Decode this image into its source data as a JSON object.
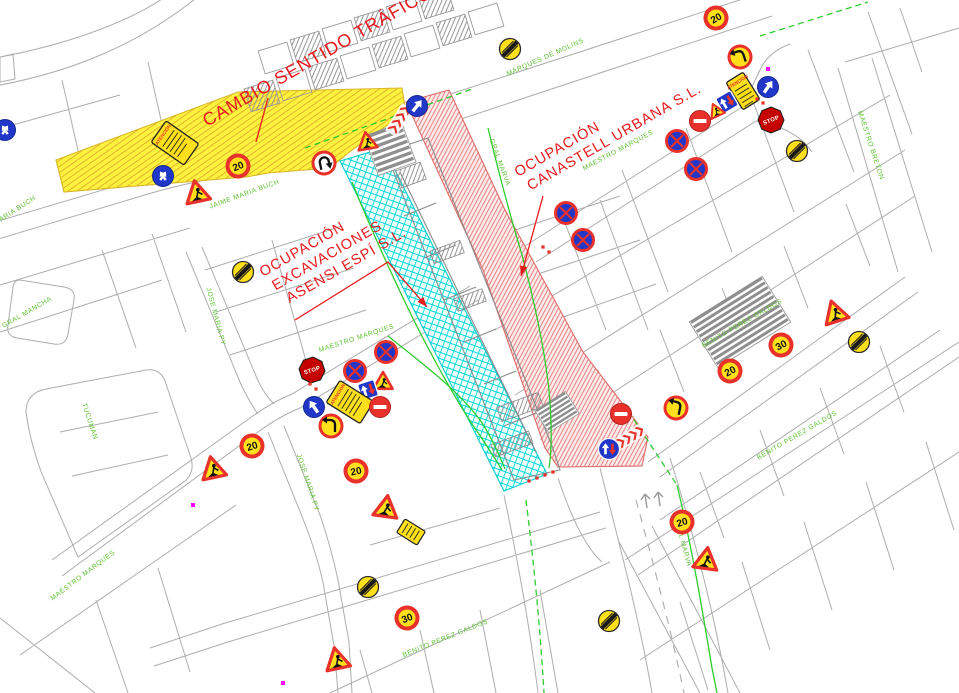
{
  "map": {
    "title": "Plano de ocupación y señalización de tráfico",
    "panel_label": "ATENCIÓN",
    "colors": {
      "parcel_line": "#adadad",
      "building_line": "#8a8a8a",
      "street_label_green": "#5cc22e",
      "annotation_red": "#e8191c",
      "green_line": "#2ecc2e",
      "zone_yellow": "#fff23f",
      "zone_cyan": "#00d8d8",
      "zone_red": "#e98080",
      "sign_red": "#e8312a",
      "sign_blue": "#2037c8",
      "sign_yellow": "#ffe01a",
      "magenta": "#ff00ff"
    },
    "annotations": [
      {
        "id": "cambio-sentido",
        "lines": [
          "CAMBIO SENTIDO TRÁFICO"
        ],
        "x": 207,
        "y": 127,
        "rot": -30,
        "size": 18,
        "leader": [
          [
            268,
            98
          ],
          [
            256,
            142
          ]
        ],
        "arrow": false
      },
      {
        "id": "ocupacion-canastell",
        "lines": [
          "OCUPACIÓN",
          "CANASTELL URBANA S.L."
        ],
        "x": 518,
        "y": 177,
        "rot": -30,
        "size": 14.5,
        "leader": [
          [
            543,
            196
          ],
          [
            521,
            276
          ]
        ],
        "arrow": true
      },
      {
        "id": "ocupacion-asensi",
        "lines": [
          "OCUPACIÓN",
          "EXCAVACIONES",
          "ASENSI ESPÍ S.L."
        ],
        "x": 263,
        "y": 277,
        "rot": -30,
        "size": 14.5,
        "leader": [
          [
            295,
            320
          ],
          [
            388,
            262
          ],
          [
            427,
            307
          ]
        ],
        "arrow": true
      }
    ],
    "street_labels": [
      {
        "text": "MARIA BUCH",
        "x": 16,
        "y": 212,
        "rot": -33
      },
      {
        "text": "JAIME MARIA BUCH",
        "x": 245,
        "y": 196,
        "rot": -20
      },
      {
        "text": "MARQUES DE MOLINS",
        "x": 546,
        "y": 59,
        "rot": -24
      },
      {
        "text": "GRAL MARVA",
        "x": 498,
        "y": 163,
        "rot": 70
      },
      {
        "text": "MAESTRO MARQUES",
        "x": 619,
        "y": 152,
        "rot": -28
      },
      {
        "text": "MAESTRO BRETON",
        "x": 869,
        "y": 146,
        "rot": 72
      },
      {
        "text": "GRAL MANCHA",
        "x": 28,
        "y": 314,
        "rot": -30
      },
      {
        "text": "JOSE MARIA PY",
        "x": 214,
        "y": 317,
        "rot": 75
      },
      {
        "text": "TUCUMAN",
        "x": 88,
        "y": 422,
        "rot": 72
      },
      {
        "text": "MAESTRO MARQUES",
        "x": 357,
        "y": 340,
        "rot": -18
      },
      {
        "text": "JOSE MARIA PY",
        "x": 306,
        "y": 483,
        "rot": 72
      },
      {
        "text": "MAESTRO MARQUES",
        "x": 84,
        "y": 577,
        "rot": -37
      },
      {
        "text": "BENITO PEREZ GALDOS",
        "x": 743,
        "y": 325,
        "rot": -30
      },
      {
        "text": "BENITO PEREZ GALDOS",
        "x": 798,
        "y": 437,
        "rot": -30
      },
      {
        "text": "BENITO PEREZ GALDOS",
        "x": 446,
        "y": 640,
        "rot": -22
      },
      {
        "text": "GRAL MARVA",
        "x": 681,
        "y": 543,
        "rot": 75
      }
    ],
    "zones": [
      {
        "id": "zone-cambio-sentido-trafico",
        "kind": "yellow",
        "points": [
          [
            56,
            160
          ],
          [
            238,
            92
          ],
          [
            402,
            88
          ],
          [
            406,
            112
          ],
          [
            352,
            150
          ],
          [
            330,
            168
          ],
          [
            268,
            173
          ],
          [
            246,
            177
          ],
          [
            64,
            192
          ]
        ]
      },
      {
        "id": "zone-ocupacion-asensi",
        "kind": "cyan",
        "points": [
          [
            340,
            161
          ],
          [
            384,
            148
          ],
          [
            547,
            474
          ],
          [
            504,
            491
          ]
        ]
      },
      {
        "id": "zone-ocupacion-canastell",
        "kind": "red",
        "points": [
          [
            406,
            102
          ],
          [
            449,
            90
          ],
          [
            505,
            210
          ],
          [
            583,
            352
          ],
          [
            648,
            437
          ],
          [
            642,
            466
          ],
          [
            558,
            467
          ],
          [
            545,
            448
          ],
          [
            483,
            270
          ]
        ]
      }
    ],
    "signs": [
      {
        "t": "panel",
        "x": 175,
        "y": 143,
        "r": -55,
        "w": 26,
        "h": 40
      },
      {
        "t": "blue-two",
        "x": 163,
        "y": 176,
        "r": 0
      },
      {
        "t": "works",
        "x": 197,
        "y": 193,
        "r": -12
      },
      {
        "t": "speed",
        "v": "20",
        "x": 238,
        "y": 166,
        "r": -22
      },
      {
        "t": "no-turn-w",
        "x": 324,
        "y": 163,
        "r": -12
      },
      {
        "t": "works",
        "x": 367,
        "y": 142,
        "r": -10,
        "s": 0.8
      },
      {
        "t": "chevrons",
        "x": 399,
        "y": 120,
        "r": -58
      },
      {
        "t": "blue-arrow",
        "x": 417,
        "y": 106,
        "r": 38
      },
      {
        "t": "end",
        "x": 243,
        "y": 272,
        "r": 0
      },
      {
        "t": "end",
        "x": 510,
        "y": 49,
        "r": 0
      },
      {
        "t": "speed",
        "v": "20",
        "x": 716,
        "y": 18,
        "r": -30
      },
      {
        "t": "no-turn-y",
        "x": 740,
        "y": 57,
        "r": -18
      },
      {
        "t": "panel",
        "x": 743,
        "y": 91,
        "r": -32,
        "w": 20,
        "h": 32
      },
      {
        "t": "blue-arrow",
        "x": 768,
        "y": 87,
        "r": 35
      },
      {
        "t": "priority",
        "x": 727,
        "y": 102,
        "r": -30
      },
      {
        "t": "works",
        "x": 716,
        "y": 111,
        "r": -25,
        "s": 0.62
      },
      {
        "t": "no-entry",
        "x": 700,
        "y": 121,
        "r": 0
      },
      {
        "t": "stop",
        "x": 771,
        "y": 120,
        "r": -22
      },
      {
        "t": "end",
        "x": 797,
        "y": 151,
        "r": 0
      },
      {
        "t": "no-parking",
        "x": 677,
        "y": 141,
        "r": 0
      },
      {
        "t": "no-parking",
        "x": 696,
        "y": 169,
        "r": 0
      },
      {
        "t": "no-parking",
        "x": 566,
        "y": 213,
        "r": 0
      },
      {
        "t": "no-parking",
        "x": 583,
        "y": 240,
        "r": 0
      },
      {
        "t": "stop",
        "x": 312,
        "y": 370,
        "r": -18
      },
      {
        "t": "no-parking",
        "x": 355,
        "y": 371,
        "r": 0
      },
      {
        "t": "no-parking",
        "x": 386,
        "y": 352,
        "r": 0
      },
      {
        "t": "works",
        "x": 383,
        "y": 382,
        "r": 0,
        "s": 0.8
      },
      {
        "t": "priority",
        "x": 368,
        "y": 390,
        "r": -18
      },
      {
        "t": "panel",
        "x": 350,
        "y": 402,
        "r": -58,
        "w": 26,
        "h": 40
      },
      {
        "t": "no-entry",
        "x": 380,
        "y": 407,
        "r": 0
      },
      {
        "t": "blue-arrow",
        "x": 314,
        "y": 407,
        "r": -35
      },
      {
        "t": "no-turn-y",
        "x": 331,
        "y": 426,
        "r": 0
      },
      {
        "t": "speed",
        "v": "20",
        "x": 356,
        "y": 471,
        "r": -12
      },
      {
        "t": "speed",
        "v": "20",
        "x": 252,
        "y": 446,
        "r": -18
      },
      {
        "t": "works",
        "x": 213,
        "y": 469,
        "r": -12
      },
      {
        "t": "works",
        "x": 386,
        "y": 508,
        "r": 8
      },
      {
        "t": "panel-small",
        "x": 411,
        "y": 532,
        "r": -58,
        "w": 16,
        "h": 24
      },
      {
        "t": "end",
        "x": 368,
        "y": 587,
        "r": 0
      },
      {
        "t": "speed",
        "v": "30",
        "x": 407,
        "y": 618,
        "r": -22
      },
      {
        "t": "works",
        "x": 337,
        "y": 660,
        "r": -12
      },
      {
        "t": "end",
        "x": 609,
        "y": 621,
        "r": 0
      },
      {
        "t": "no-entry",
        "x": 621,
        "y": 414,
        "r": 0
      },
      {
        "t": "chevrons",
        "x": 630,
        "y": 437,
        "r": -32
      },
      {
        "t": "priority-circle",
        "x": 609,
        "y": 449,
        "r": 0
      },
      {
        "t": "no-turn-y",
        "x": 676,
        "y": 408,
        "r": 12
      },
      {
        "t": "speed",
        "v": "20",
        "x": 682,
        "y": 522,
        "r": -18
      },
      {
        "t": "works",
        "x": 706,
        "y": 560,
        "r": 8
      },
      {
        "t": "speed",
        "v": "20",
        "x": 730,
        "y": 371,
        "r": -28
      },
      {
        "t": "speed",
        "v": "30",
        "x": 781,
        "y": 345,
        "r": -28
      },
      {
        "t": "works",
        "x": 835,
        "y": 313,
        "r": -18
      },
      {
        "t": "end",
        "x": 859,
        "y": 342,
        "r": 0
      },
      {
        "t": "blue-two",
        "x": 5,
        "y": 130,
        "r": 0
      }
    ],
    "magenta_dots": [
      [
        768,
        69
      ],
      [
        193,
        505
      ],
      [
        283,
        683
      ]
    ],
    "red_dots": [
      [
        529,
        481
      ],
      [
        537,
        478
      ],
      [
        545,
        475
      ],
      [
        553,
        472
      ],
      [
        310,
        384
      ],
      [
        316,
        389
      ],
      [
        543,
        247
      ],
      [
        549,
        252
      ],
      [
        757,
        99
      ],
      [
        763,
        103
      ]
    ]
  }
}
